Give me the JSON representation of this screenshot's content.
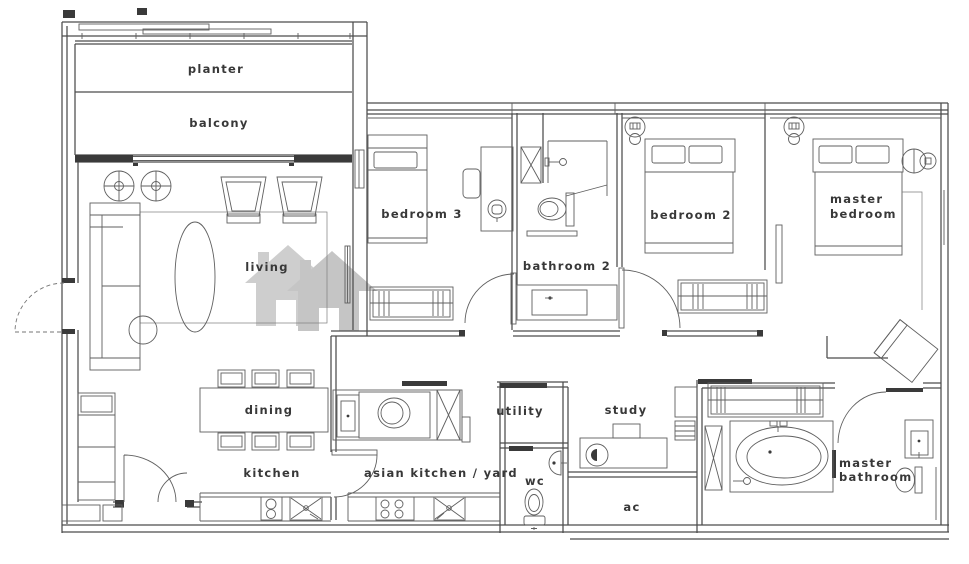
{
  "theme": {
    "wall_color": "#4c4c4c",
    "line_color": "#5f5f5f",
    "dark_color": "#3a3a3a",
    "label_color": "#383838",
    "watermark_color": "#c6c6c6",
    "background": "#ffffff"
  },
  "rooms": {
    "planter": {
      "label": "planter"
    },
    "balcony": {
      "label": "balcony"
    },
    "living": {
      "label": "living"
    },
    "bedroom3": {
      "label": "bedroom 3"
    },
    "bathroom2": {
      "label": "bathroom 2"
    },
    "bedroom2": {
      "label": "bedroom 2"
    },
    "master_bedroom": {
      "line1": "master",
      "line2": "bedroom"
    },
    "dining": {
      "label": "dining"
    },
    "kitchen": {
      "label": "kitchen"
    },
    "asian_kitchen": {
      "label": "asian kitchen / yard"
    },
    "utility": {
      "label": "utility"
    },
    "study": {
      "label": "study"
    },
    "wc": {
      "label": "wc"
    },
    "ac": {
      "label": "ac"
    },
    "master_bathroom": {
      "line1": "master",
      "line2": "bathroom"
    }
  },
  "fixtures": {
    "living": [
      "sofa-icon",
      "round-side-table-icon",
      "armchair-icon",
      "rug-icon",
      "tv-icon"
    ],
    "dining": [
      "dining-table-icon",
      "chair-icon"
    ],
    "kitchen": [
      "counter-icon",
      "hob-icon",
      "sink-icon"
    ],
    "asian_kitchen": [
      "counter-icon",
      "hob-icon",
      "sink-icon",
      "washer-icon",
      "shaft-icon",
      "door-swing-icon"
    ],
    "utility": [
      "sliding-door-icon"
    ],
    "wc": [
      "toilet-icon",
      "basin-icon",
      "sliding-door-icon"
    ],
    "study": [
      "desk-icon",
      "office-chair-icon",
      "monitor-icon",
      "shelf-icon"
    ],
    "bedroom3": [
      "single-bed-icon",
      "desk-icon",
      "office-chair-icon",
      "wardrobe-icon",
      "door-swing-icon"
    ],
    "bathroom2": [
      "shower-icon",
      "toilet-icon",
      "vanity-icon",
      "shaft-icon"
    ],
    "bedroom2": [
      "double-bed-icon",
      "wardrobe-icon",
      "ceiling-lamp-icon",
      "door-swing-icon"
    ],
    "master_bedroom": [
      "double-bed-icon",
      "bedside-lamp-icon",
      "armchair-icon",
      "ceiling-lamp-icon"
    ],
    "master_bathroom": [
      "wardrobe-icon",
      "bathtub-icon",
      "vanity-icon",
      "toilet-icon",
      "shaft-icon",
      "sliding-door-icon",
      "door-swing-icon"
    ],
    "entry": [
      "door-swing-dashed-icon"
    ]
  },
  "watermark": {
    "icon": "twin-house-watermark-icon"
  }
}
